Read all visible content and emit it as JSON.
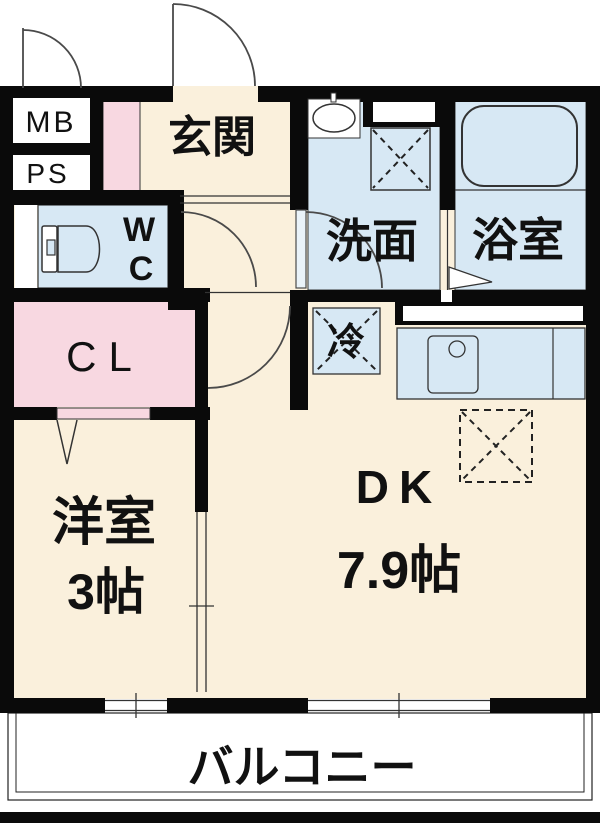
{
  "floor_plan": {
    "rooms": {
      "meter_box": {
        "label": "MB"
      },
      "pipe_space": {
        "label": "PS"
      },
      "entrance": {
        "label": "玄関"
      },
      "toilet": {
        "label_top": "W",
        "label_bottom": "C"
      },
      "washroom": {
        "label": "洗面"
      },
      "bathroom": {
        "label": "浴室"
      },
      "closet": {
        "label": "CL"
      },
      "refrigerator_space": {
        "label": "冷"
      },
      "dining_kitchen": {
        "label": "DK",
        "size": "7.9帖"
      },
      "western_room": {
        "label": "洋室",
        "size": "3帖"
      },
      "balcony": {
        "label": "バルコニー"
      }
    },
    "colors": {
      "room_cream": "#FAF0DC",
      "wet_area_blue": "#D7E8F4",
      "closet_pink": "#F8D8E1",
      "wall_black": "#0A0A0A",
      "line_dark": "#333333",
      "background_white": "#FFFFFF"
    }
  }
}
